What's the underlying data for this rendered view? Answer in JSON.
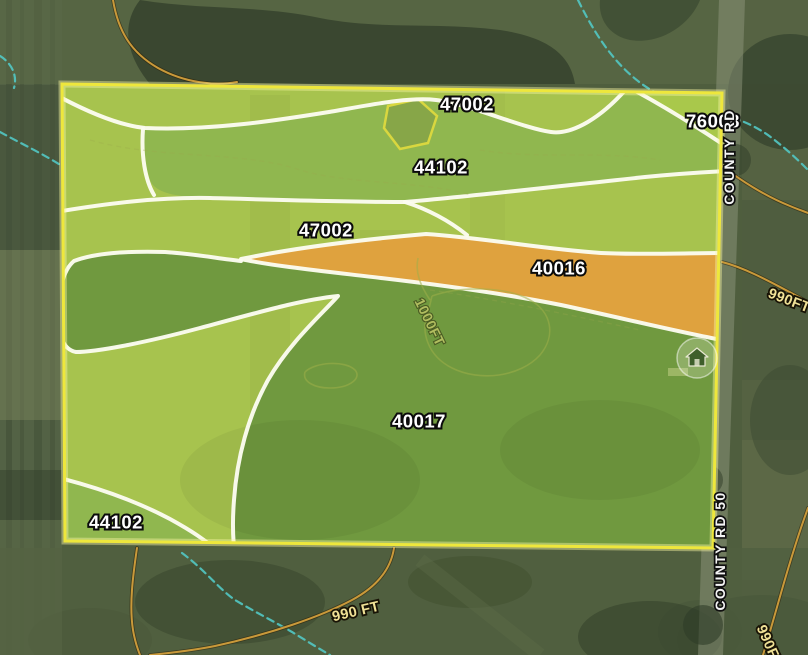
{
  "map": {
    "type": "soil-survey-parcel-map",
    "soil_labels": [
      {
        "code": "47002",
        "region_color": "#a7c34e"
      },
      {
        "code": "76008",
        "region_color": "#a9c84b"
      },
      {
        "code": "44102",
        "region_color": "#90b74f"
      },
      {
        "code": "47002",
        "region_color": "#a7c34e"
      },
      {
        "code": "40016",
        "region_color": "#dfa23e"
      },
      {
        "code": "40017",
        "region_color": "#70993f"
      },
      {
        "code": "44102",
        "region_color": "#90b74f"
      }
    ],
    "contour_labels": [
      {
        "text": "990FT"
      },
      {
        "text": "1000FT"
      },
      {
        "text": "990 FT"
      },
      {
        "text": "990FT"
      }
    ],
    "road_labels": [
      {
        "text": "COUNTY RD"
      },
      {
        "text": "COUNTY RD 50"
      }
    ],
    "poi": {
      "icon": "barn-home-marker"
    },
    "colors": {
      "parcel_border": "#eee73c",
      "soil_boundary": "#fcfcf0",
      "contour_line": "#c9993a",
      "contour_label": "#f0e196",
      "stream": "#52c8c4",
      "orange_soil": "#dfa23e",
      "dark_green_soil": "#70993f",
      "light_green_soil": "#a7c34e"
    }
  }
}
